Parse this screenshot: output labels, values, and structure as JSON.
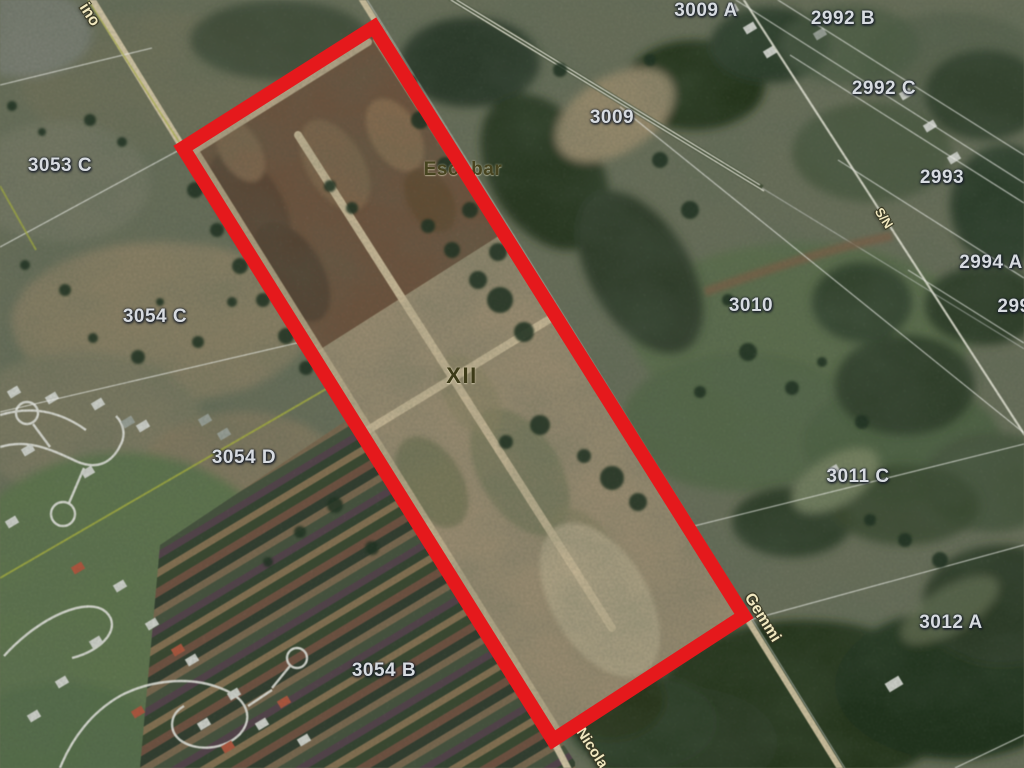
{
  "map": {
    "type": "satellite-cadastral-view",
    "colors": {
      "highlight": "#e5191c",
      "parcel_label": "#d7dbe0",
      "street_label": "#f1e8bf",
      "locality_label": "#474420"
    },
    "locality_labels": [
      {
        "text": "Escobar"
      },
      {
        "text": "XII"
      }
    ],
    "parcel_labels": [
      {
        "text": "3053 C"
      },
      {
        "text": "3054 C"
      },
      {
        "text": "3054 D"
      },
      {
        "text": "3054 B"
      },
      {
        "text": "3009 A"
      },
      {
        "text": "3009"
      },
      {
        "text": "2992 B"
      },
      {
        "text": "2992 C"
      },
      {
        "text": "2993"
      },
      {
        "text": "2994 A"
      },
      {
        "text": "299"
      },
      {
        "text": "3010"
      },
      {
        "text": "3011 C"
      },
      {
        "text": "3012 A"
      }
    ],
    "street_labels": [
      {
        "text": "ino"
      },
      {
        "text": "S/N"
      },
      {
        "text": "Gemmi"
      },
      {
        "text": "Nicola"
      }
    ]
  }
}
